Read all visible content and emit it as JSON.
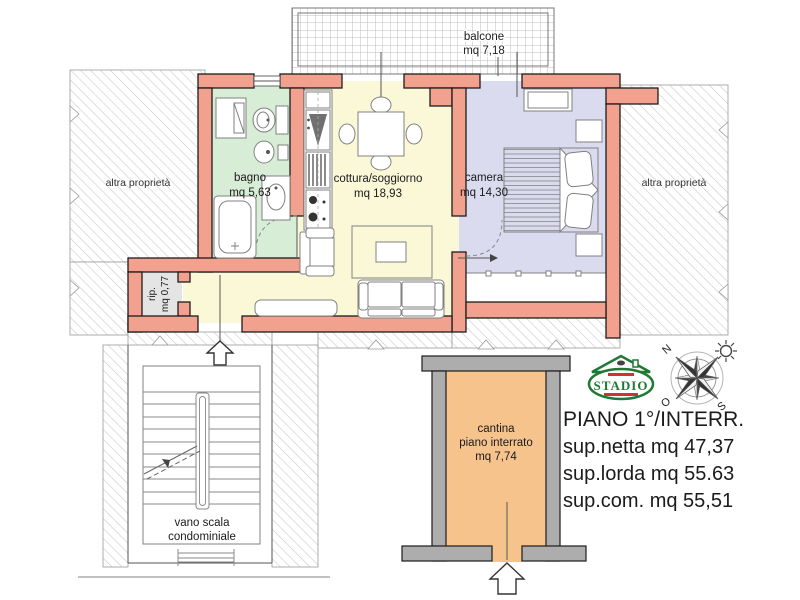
{
  "rooms": {
    "balcone": {
      "name": "balcone",
      "area": "mq 7,18"
    },
    "bagno": {
      "name": "bagno",
      "area": "mq 5,63"
    },
    "cottura": {
      "name": "cottura/soggiorno",
      "area": "mq 18,93"
    },
    "camera": {
      "name": "camera",
      "area": "mq 14,30"
    },
    "rip": {
      "name": "rip.",
      "area": "mq 0,77"
    },
    "cantina": {
      "name": "cantina",
      "floor": "piano interrato",
      "area": "mq 7,74"
    },
    "stairs": {
      "line1": "vano scala",
      "line2": "condominiale"
    },
    "other_property_left": "altra proprietà",
    "other_property_right": "altra proprietà"
  },
  "info": {
    "title": "PIANO 1°/INTERR.",
    "lines": [
      "sup.netta mq 47,37",
      "sup.lorda mq 55.63",
      "sup.com. mq 55,51"
    ]
  },
  "compass": {
    "north": "N",
    "west": "O",
    "south": "S"
  },
  "logo": {
    "text": "STADIO"
  },
  "colors": {
    "wall": "#F1A18E",
    "bagno": "#D8EDD6",
    "cottura": "#FBF8D8",
    "camera": "#DADBEF",
    "cantina": "#F6C38D",
    "rip": "#E4E4E4",
    "cantina_wall": "#ADADAD",
    "hatch_line": "#CBCBCB",
    "logo_green": "#1E7A33"
  }
}
